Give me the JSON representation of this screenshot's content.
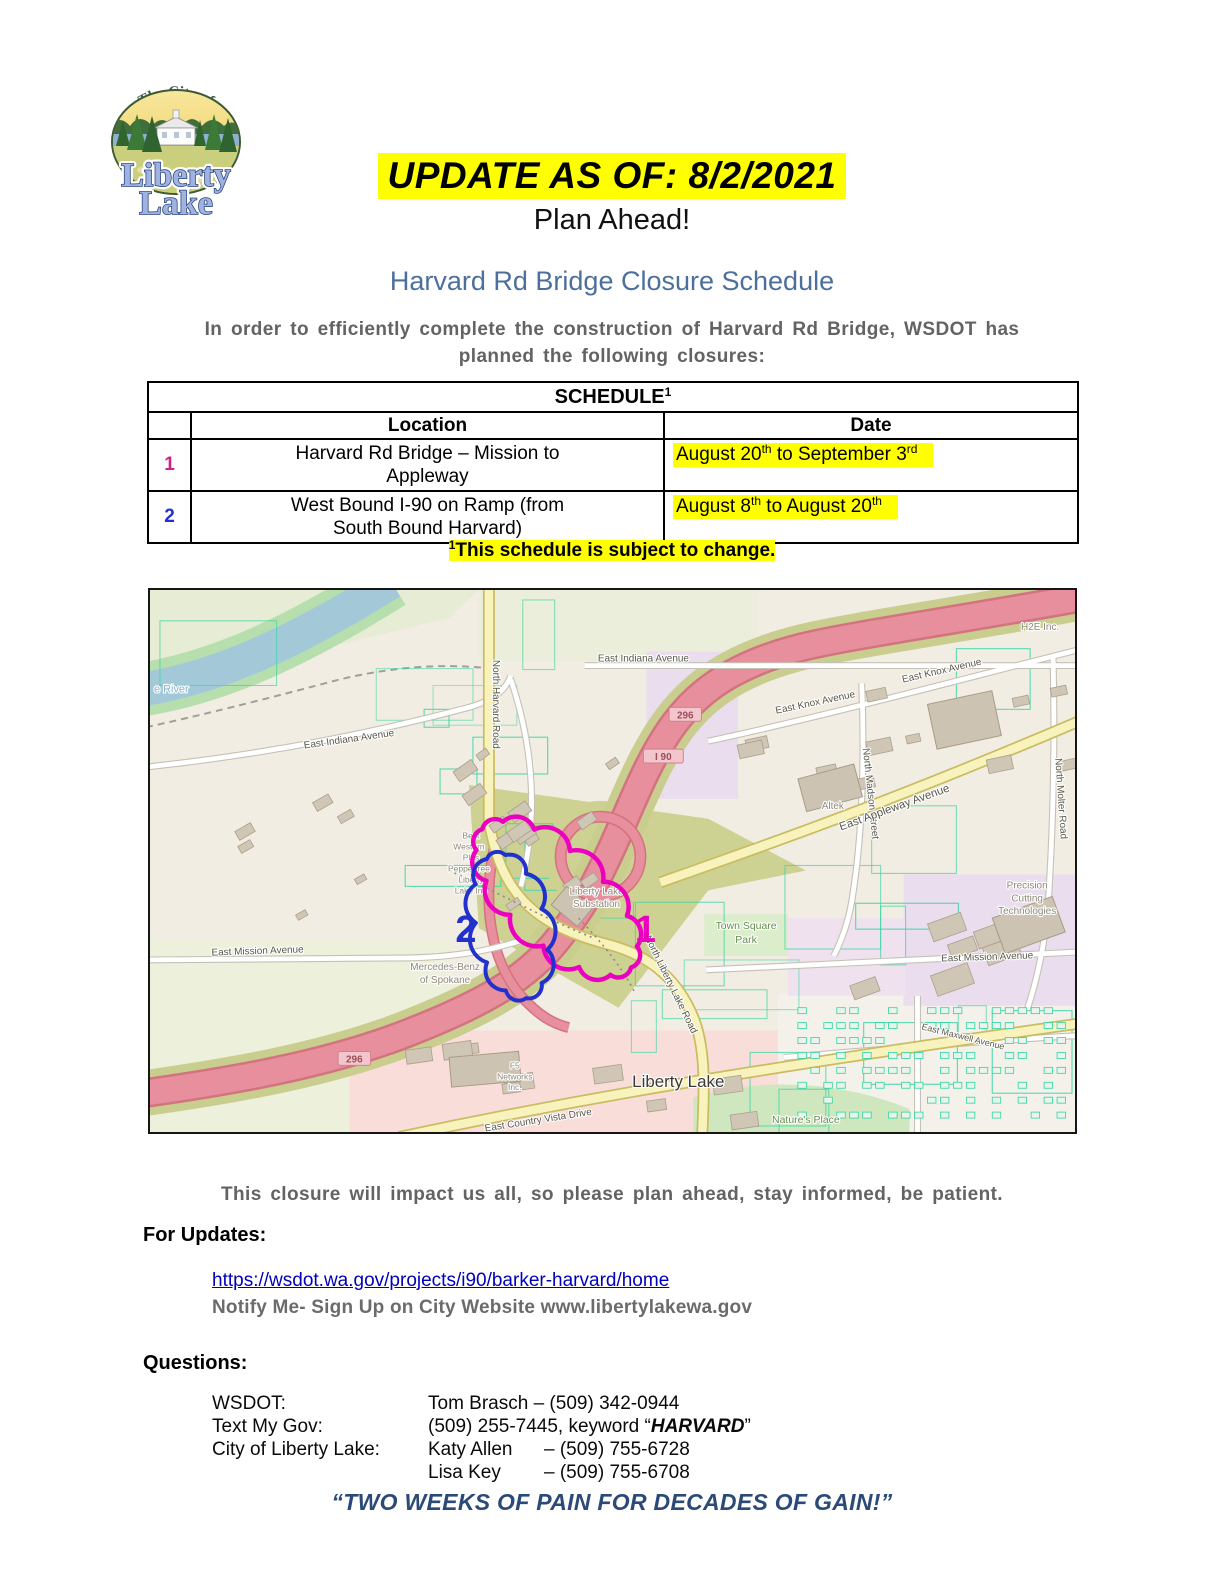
{
  "colors": {
    "highlight": "#ffff00",
    "subtitle_blue": "#4d6f9c",
    "footer_navy": "#2b4a77",
    "link_blue": "#0000bb"
  },
  "logo": {
    "arc_text": "The City of",
    "line1": "Liberty",
    "line2": "Lake"
  },
  "header": {
    "update_banner": "UPDATE AS OF: 8/2/2021",
    "plan_ahead": "Plan Ahead!",
    "subtitle": "Harvard Rd Bridge Closure Schedule",
    "intro_line1": "In order to efficiently complete the construction of Harvard Rd Bridge, WSDOT has",
    "intro_line2": "planned the following closures:"
  },
  "schedule_table": {
    "title": "SCHEDULE",
    "title_sup": "1",
    "columns": [
      "",
      "Location",
      "Date"
    ],
    "rows": [
      {
        "num": "1",
        "color": "#cb2387",
        "loc1": "Harvard Rd Bridge – Mission to",
        "loc2": "Appleway",
        "d1": "August 20",
        "ds1": "th",
        "d2": " to September 3",
        "ds2": "rd"
      },
      {
        "num": "2",
        "color": "#2231cd",
        "loc1": "West Bound I-90 on Ramp (from",
        "loc2": "South Bound Harvard)",
        "d1": "August 8",
        "ds1": "th",
        "d2": " to August 20",
        "ds2": "th"
      }
    ],
    "footnote_sup": "1",
    "footnote": "This schedule is subject to change."
  },
  "impact_line": "This closure will impact us all, so please plan ahead, stay informed, be patient.",
  "updates": {
    "heading": "For Updates:",
    "link": "https://wsdot.wa.gov/projects/i90/barker-harvard/home",
    "notify": "Notify Me- Sign Up on City Website www.libertylakewa.gov"
  },
  "questions": {
    "heading": "Questions:",
    "rows": [
      {
        "label": "WSDOT:",
        "value": "Tom Brasch – (509) 342-0944"
      },
      {
        "label": "Text My Gov:",
        "pre": "(509) 255-7445, keyword “",
        "keyword": "HARVARD",
        "post": "”"
      },
      {
        "label": "City of Liberty Lake:",
        "name": "Katy Allen",
        "value": "– (509) 755-6728"
      },
      {
        "label": "",
        "name": "Lisa Key",
        "value": "– (509) 755-6708"
      }
    ]
  },
  "footer_quote": "“TWO WEEKS OF PAIN FOR DECADES OF GAIN!”",
  "map": {
    "labels": [
      {
        "t": "e River",
        "x": 4,
        "y": 103,
        "r": 0,
        "c": "water",
        "a": "start"
      },
      {
        "t": "East Indiana Avenue",
        "x": 200,
        "y": 153,
        "r": -8,
        "c": "road"
      },
      {
        "t": "East Indiana Avenue",
        "x": 495,
        "y": 72,
        "r": 0,
        "c": "road"
      },
      {
        "t": "North Harvard Road",
        "x": 344,
        "y": 115,
        "r": 90,
        "c": "road"
      },
      {
        "t": "296",
        "x": 537,
        "y": 128,
        "c": "shield"
      },
      {
        "t": "I 90",
        "x": 515,
        "y": 170,
        "c": "shield"
      },
      {
        "t": "296",
        "x": 205,
        "y": 474,
        "c": "shield"
      },
      {
        "t": "East Knox Avenue",
        "x": 795,
        "y": 84,
        "r": -13,
        "c": "road"
      },
      {
        "t": "East Knox Avenue",
        "x": 668,
        "y": 116,
        "r": -12,
        "c": "road"
      },
      {
        "t": "H2E Inc.",
        "x": 893,
        "y": 40,
        "r": 0,
        "c": "poi"
      },
      {
        "t": "North Madson Street",
        "x": 720,
        "y": 205,
        "r": 84,
        "c": "road"
      },
      {
        "t": "Altek",
        "x": 685,
        "y": 220,
        "r": 0,
        "c": "poi"
      },
      {
        "t": "East Appleway Avenue",
        "x": 748,
        "y": 222,
        "r": -20,
        "c": "road-lg"
      },
      {
        "t": "North Molter Road",
        "x": 911,
        "y": 210,
        "r": 86,
        "c": "road"
      },
      {
        "t": "Precision",
        "x": 880,
        "y": 300,
        "c": "poi"
      },
      {
        "t": "Cutting",
        "x": 880,
        "y": 313,
        "c": "poi"
      },
      {
        "t": "Technologies",
        "x": 880,
        "y": 326,
        "c": "poi"
      },
      {
        "t": "Town Square",
        "x": 598,
        "y": 341,
        "c": "park"
      },
      {
        "t": "Park",
        "x": 598,
        "y": 355,
        "c": "park"
      },
      {
        "t": "East Mission Avenue",
        "x": 840,
        "y": 372,
        "r": -2,
        "c": "road"
      },
      {
        "t": "East Mission Avenue",
        "x": 108,
        "y": 366,
        "r": -2,
        "c": "road"
      },
      {
        "t": "Mercedes-Benz",
        "x": 296,
        "y": 382,
        "c": "poi"
      },
      {
        "t": "of Spokane",
        "x": 296,
        "y": 395,
        "c": "poi"
      },
      {
        "t": "Liberty Lake",
        "x": 448,
        "y": 306,
        "c": "poi"
      },
      {
        "t": "Substation",
        "x": 448,
        "y": 319,
        "c": "poi"
      },
      {
        "t": "Best",
        "x": 322,
        "y": 250,
        "c": "poi-sm"
      },
      {
        "t": "Western",
        "x": 320,
        "y": 261,
        "c": "poi-sm"
      },
      {
        "t": "Plus",
        "x": 322,
        "y": 272,
        "c": "poi-sm"
      },
      {
        "t": "Peppertree",
        "x": 320,
        "y": 283,
        "c": "poi-sm"
      },
      {
        "t": "Liberty",
        "x": 322,
        "y": 294,
        "c": "poi-sm"
      },
      {
        "t": "Lake Inn",
        "x": 322,
        "y": 305,
        "c": "poi-sm"
      },
      {
        "t": "North Liberty Lake Road",
        "x": 520,
        "y": 398,
        "r": 64,
        "c": "road"
      },
      {
        "t": "F5",
        "x": 366,
        "y": 481,
        "c": "poi-sm"
      },
      {
        "t": "Networks",
        "x": 366,
        "y": 492,
        "c": "poi-sm"
      },
      {
        "t": "Inc.",
        "x": 366,
        "y": 503,
        "c": "poi-sm"
      },
      {
        "t": "East Country Vista Drive",
        "x": 390,
        "y": 536,
        "r": -9,
        "c": "road"
      },
      {
        "t": "Liberty Lake",
        "x": 530,
        "y": 500,
        "c": "town"
      },
      {
        "t": "Nature's Place",
        "x": 658,
        "y": 536,
        "c": "park"
      },
      {
        "t": "East Maxwell Avenue",
        "x": 815,
        "y": 452,
        "r": 14,
        "c": "road-sm"
      }
    ],
    "annotations": [
      {
        "num": "1",
        "x": 497,
        "y": 354,
        "color": "#ec00c0"
      },
      {
        "num": "2",
        "x": 317,
        "y": 354,
        "color": "#2231cd"
      }
    ]
  }
}
